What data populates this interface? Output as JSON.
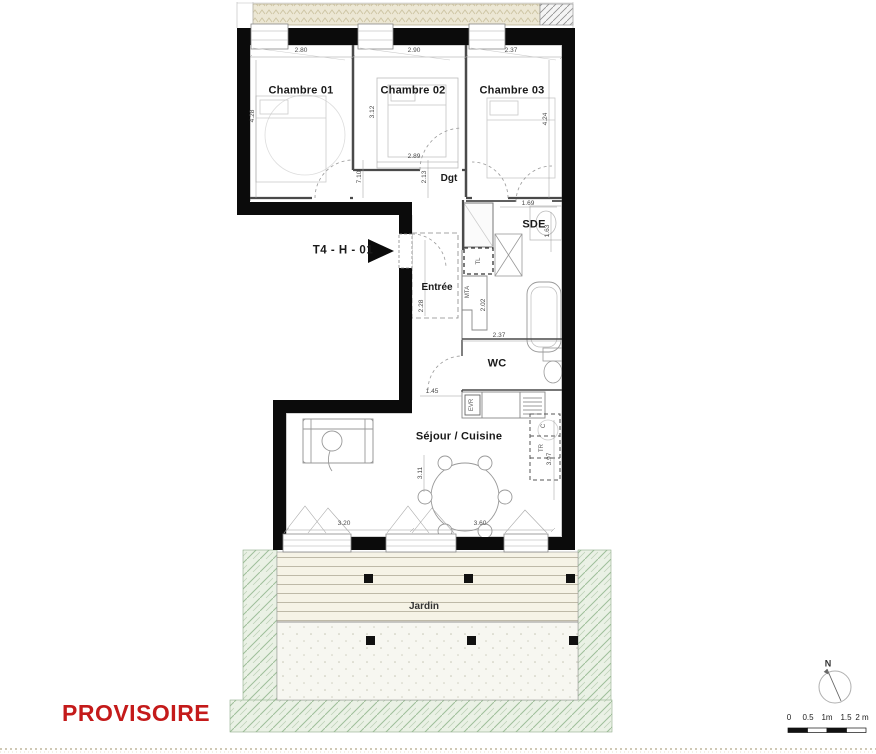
{
  "unit_label": "T4 - H - 01",
  "watermark": "PROVISOIRE",
  "rooms": {
    "chambre01": "Chambre 01",
    "chambre02": "Chambre 02",
    "chambre03": "Chambre 03",
    "dgt": "Dgt",
    "sde": "SDE",
    "entree": "Entrée",
    "wc": "WC",
    "sejour": "Séjour / Cuisine",
    "jardin": "Jardin"
  },
  "dims": {
    "c1_width": "2.80",
    "c2_width": "2.90",
    "c3_width": "2.37",
    "c1_height": "4.28",
    "c2_height": "3.12",
    "c3_height": "4.24",
    "c2_bottom": "2.89",
    "hall_height": "7.10",
    "dgt_height": "2.13",
    "sde_width": "1.69",
    "sde_height": "1.63",
    "bath_width": "2.37",
    "entree_height": "2.28",
    "mta_height": "2.02",
    "wc_width": "1.45",
    "stock_height": "3.97",
    "sejour_height": "3.11",
    "sejour_left_width": "3.20",
    "sejour_right_width": "3.60"
  },
  "equipment": {
    "tl": "TL",
    "mta": "MTA",
    "evr": "EVR",
    "c": "C",
    "tr": "TR"
  },
  "scale_bar": {
    "ticks": [
      "0",
      "0.5",
      "1m",
      "1.5",
      "2 m"
    ]
  },
  "compass": {
    "label": "N"
  },
  "colors": {
    "wall": "#0b0b0b",
    "watermark_red": "#c41a1a",
    "garden_green": "#9fbf9a",
    "hatch_beige": "#cdc4a2"
  }
}
